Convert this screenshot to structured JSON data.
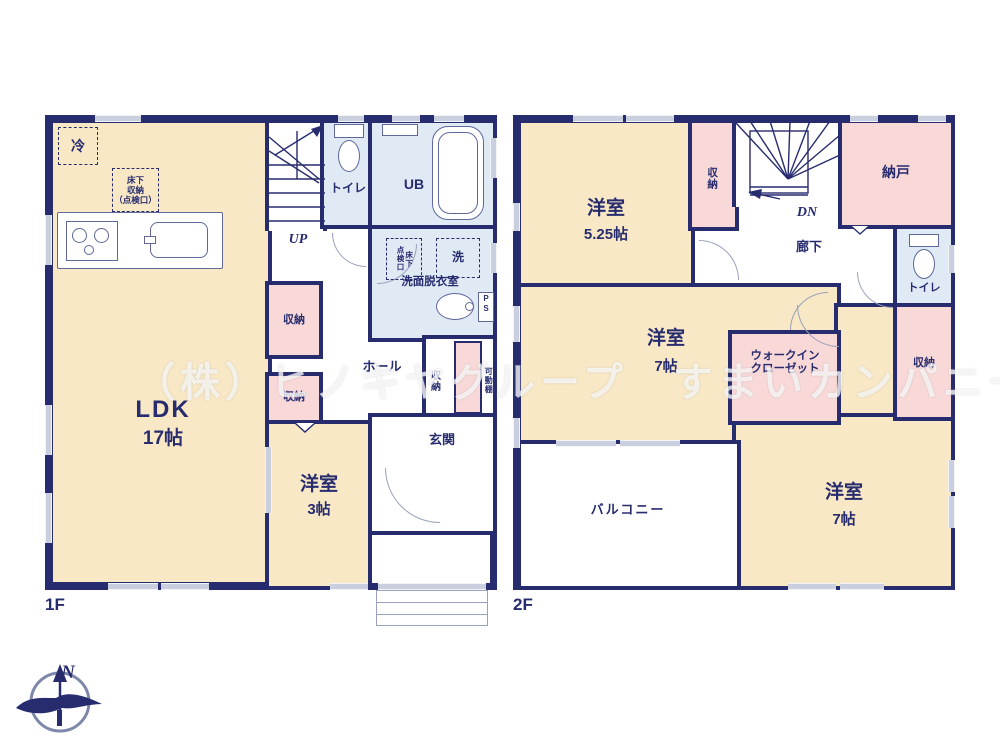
{
  "watermark": "（株）ヒノキヤグループ　すまいカンパニー　上尾店",
  "compass": {
    "north": "N"
  },
  "floor1": {
    "floor_label": "1F",
    "ldk": {
      "name": "LDK",
      "size": "17帖"
    },
    "youshitsu3": {
      "name": "洋室",
      "size": "3帖"
    },
    "stairs_up": "UP",
    "toilet": "トイレ",
    "unit_bath": "UB",
    "washroom": "洗面脱衣室",
    "washer": "洗",
    "inspection_vert": "点検口",
    "underfloor_vert": "床下",
    "fridge": "冷",
    "underfloor_storage": "床下\n収納\n（点検口）",
    "hall": "ホール",
    "entrance": "玄関",
    "storage1": "収納",
    "storage2": "収納",
    "storage_genkan": "収納",
    "movable_shelf": "可動棚",
    "pipe_space": "P\nS"
  },
  "floor2": {
    "floor_label": "2F",
    "youshitsu525": {
      "name": "洋室",
      "size": "5.25帖"
    },
    "youshitsu7a": {
      "name": "洋室",
      "size": "7帖"
    },
    "youshitsu7b": {
      "name": "洋室",
      "size": "7帖"
    },
    "stairs_down": "DN",
    "storage_top": "収納",
    "storage_right": "収納",
    "nando": "納戸",
    "hallway": "廊下",
    "toilet": "トイレ",
    "walk_in_closet": "ウォークイン\nクローゼット",
    "balcony": "バルコニー"
  }
}
